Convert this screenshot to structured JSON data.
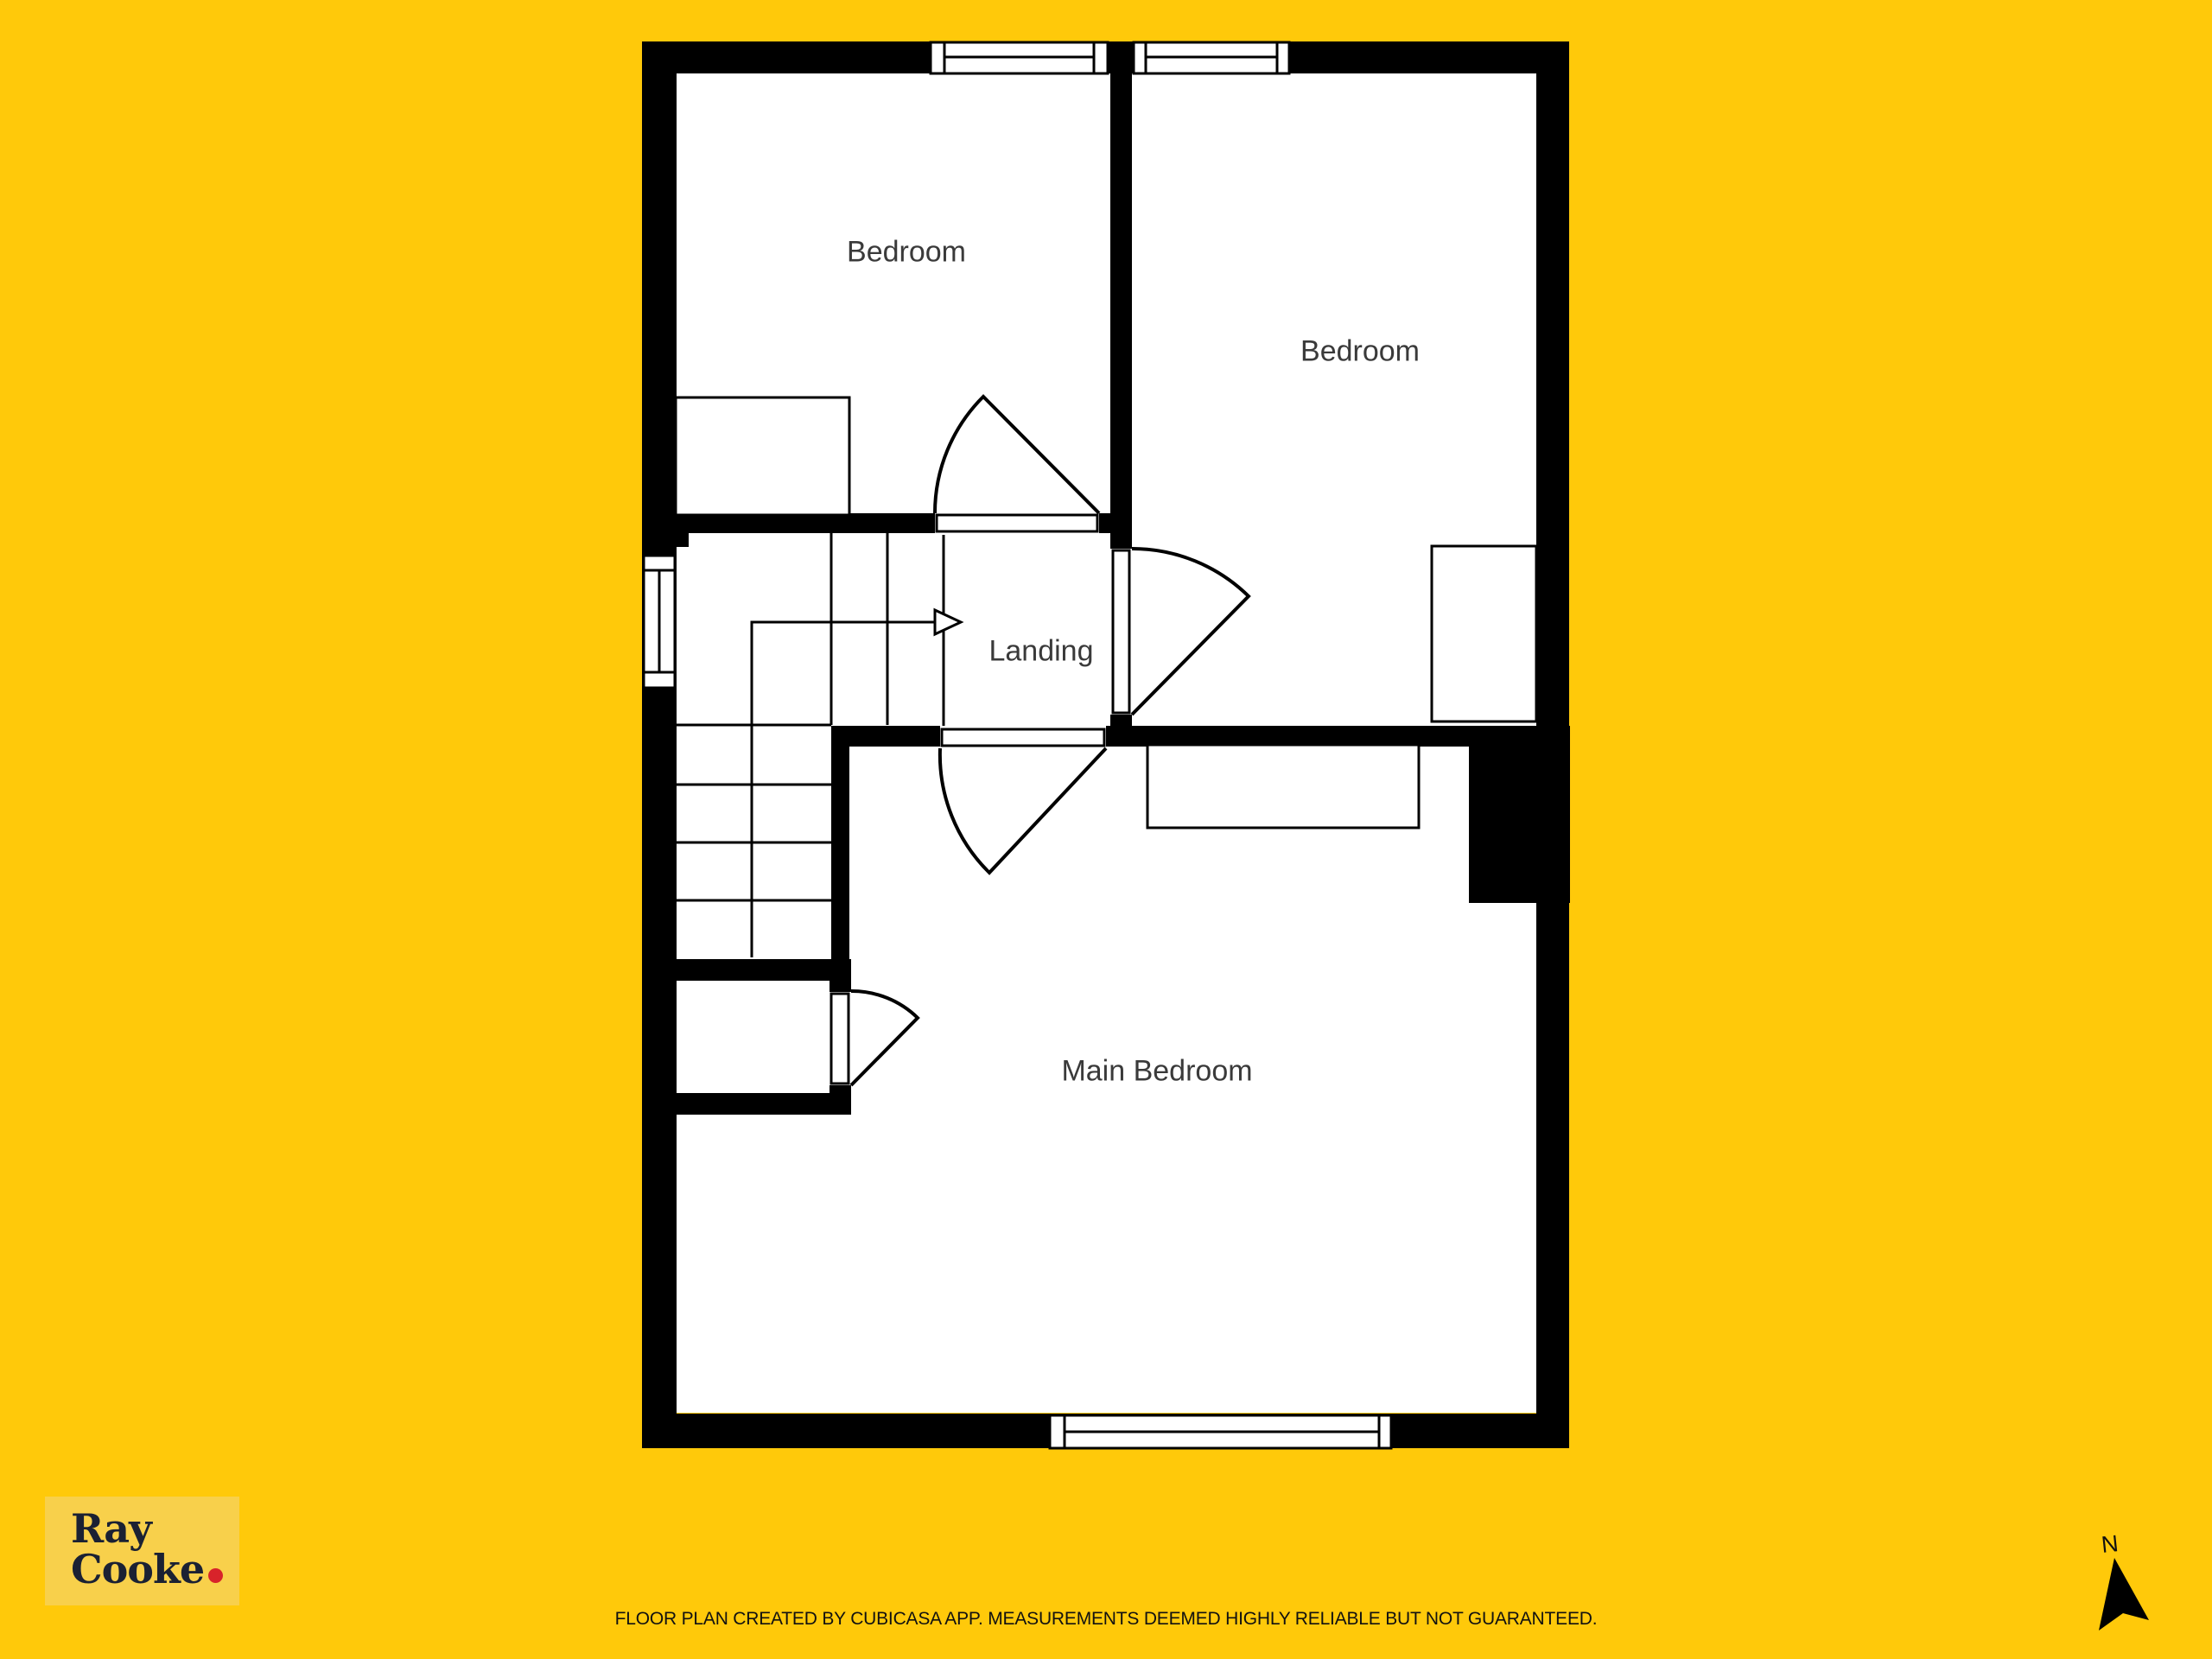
{
  "background_color": "#ffc90a",
  "plan": {
    "wall_color": "#000000",
    "floor_color": "#ffffff",
    "rooms": {
      "bedroom_top_left": {
        "label": "Bedroom"
      },
      "bedroom_top_right": {
        "label": "Bedroom"
      },
      "landing": {
        "label": "Landing"
      },
      "main_bedroom": {
        "label": "Main Bedroom"
      }
    },
    "features": {
      "windows": 4,
      "doors": 4,
      "stairs": "double-run with winder and walk-line arrow"
    }
  },
  "branding": {
    "logo_line1": "Ray",
    "logo_line2": "Cooke",
    "logo_dot": ".",
    "logo_text_color": "#1b2133",
    "logo_dot_color": "#d8232a",
    "logo_box_color": "#f8d04b"
  },
  "footer": {
    "disclaimer": "FLOOR PLAN CREATED BY CUBICASA APP. MEASUREMENTS DEEMED HIGHLY RELIABLE BUT NOT GUARANTEED."
  },
  "compass": {
    "label": "N"
  }
}
